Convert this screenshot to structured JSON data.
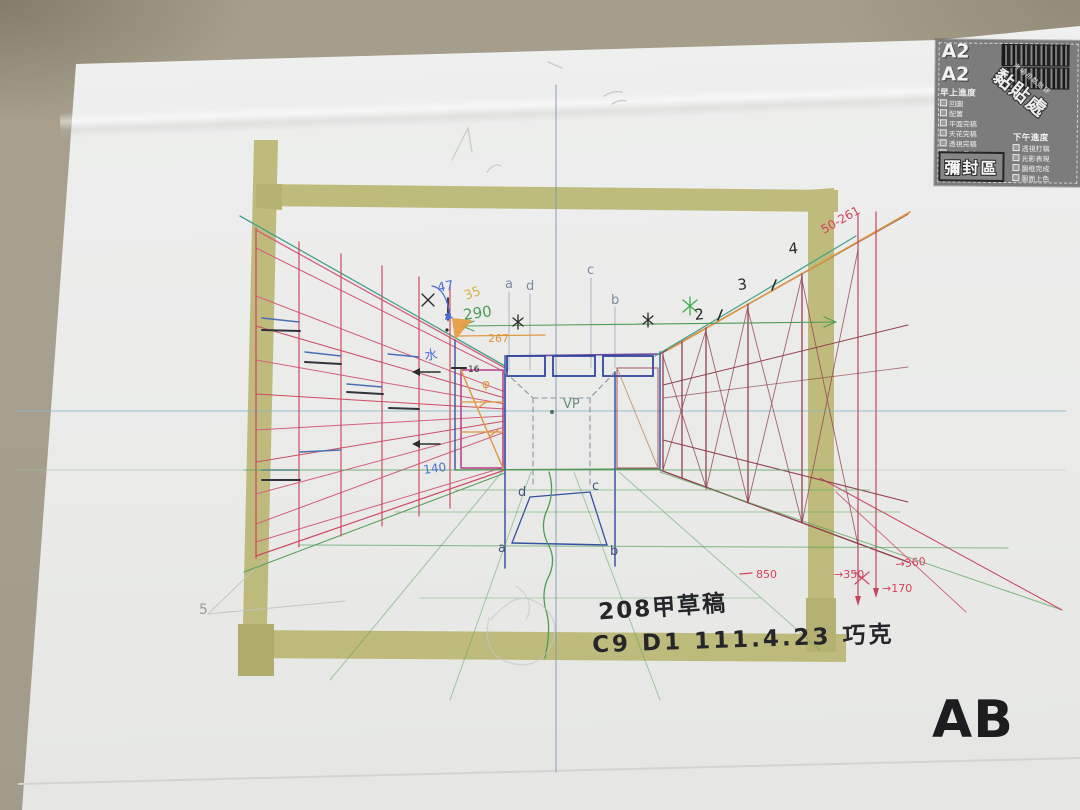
{
  "photo": {
    "corner_label": "AB",
    "handwriting_line1": "208甲草稿",
    "handwriting_line2": "C9 D1 111.4.23 巧克"
  },
  "sticker": {
    "size_label_1": "A2",
    "size_label_2": "A2",
    "morning": {
      "header": "早上進度",
      "items": [
        "回圖",
        "配置",
        "平面完稿",
        "天花完稿",
        "透視完稿",
        "標註尺寸"
      ]
    },
    "afternoon": {
      "header": "下午進度",
      "items": [
        "透視打稿",
        "光影表現",
        "圖框完成",
        "圖面上色"
      ]
    },
    "paste_area_small": "考場用黏貼膠",
    "paste_area_large": "黏貼處",
    "seal_label": "彌封區"
  },
  "drawing": {
    "vp": "VP",
    "letters_top": [
      "a",
      "d",
      "c",
      "b"
    ],
    "letters_floor": [
      "a",
      "b",
      "c",
      "d"
    ],
    "blue_47": "47",
    "orange_35": "35",
    "green_290": "290",
    "orange_267": "267",
    "seq": [
      "2",
      "3",
      "4"
    ],
    "red_diag_label": "50-261",
    "red_850": "850",
    "red_360": "→360",
    "red_350": "→350",
    "red_170": "→170",
    "gray_5": "5",
    "blue_water": "水",
    "blue_140": "140",
    "black_16": "16",
    "phi": "φ"
  },
  "colors": {
    "desk": "#a69e8b",
    "paper": "#edeeed",
    "tape": "#b3af62",
    "left_wall_pink": "#d65f7d",
    "right_wall_maroon": "#93404f",
    "back_wall_blue": "#31479e",
    "floor_green": "#4d9c55",
    "teal": "#43a18b",
    "orange": "#e2953d",
    "crimson": "#cf4c66",
    "horizon_blue": "#8fb7c8"
  }
}
